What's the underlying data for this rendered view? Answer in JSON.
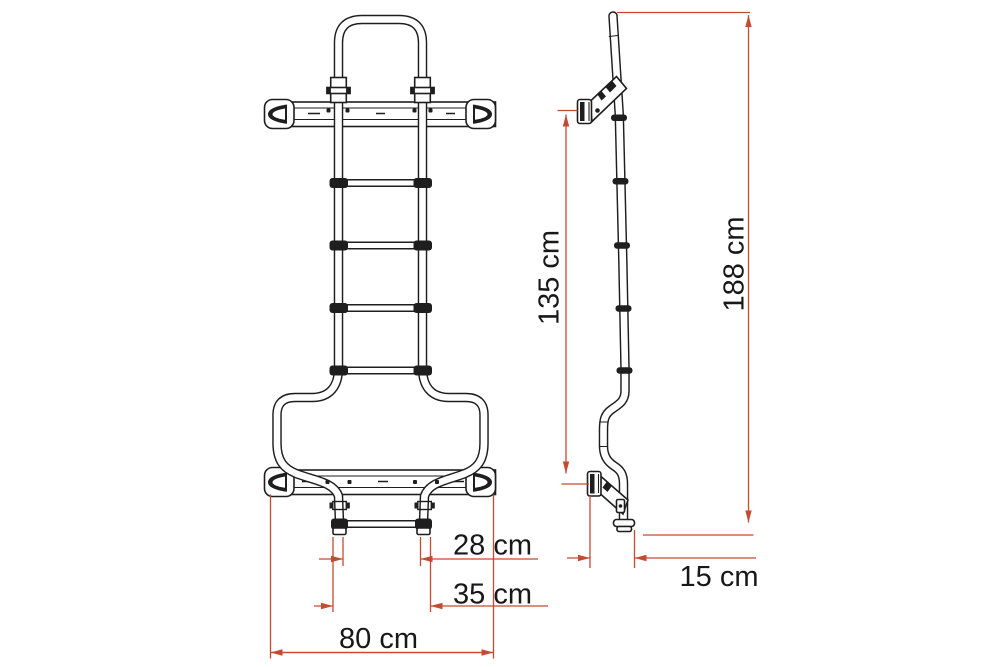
{
  "diagram": {
    "type": "technical-drawing",
    "subject": "vehicle roof ladder, orthographic front and side views with dimension callouts",
    "colors": {
      "line": "#1e1e1e",
      "dimension": "#c54a32",
      "text": "#181818",
      "background": "#ffffff"
    },
    "views": [
      {
        "id": "front",
        "description": "front view of ladder"
      },
      {
        "id": "side",
        "description": "side profile view of ladder"
      }
    ],
    "dimensions": {
      "front": [
        {
          "name": "inner-foot-spacing",
          "label": "28 cm",
          "value": 28,
          "unit": "cm"
        },
        {
          "name": "outer-foot-spacing",
          "label": "35 cm",
          "value": 35,
          "unit": "cm"
        },
        {
          "name": "overall-width",
          "label": "80 cm",
          "value": 80,
          "unit": "cm"
        }
      ],
      "side": [
        {
          "name": "bracket-to-foot-height",
          "label": "135 cm",
          "value": 135,
          "unit": "cm"
        },
        {
          "name": "overall-height",
          "label": "188 cm",
          "value": 188,
          "unit": "cm"
        },
        {
          "name": "standoff-depth",
          "label": "15 cm",
          "value": 15,
          "unit": "cm"
        }
      ]
    }
  }
}
